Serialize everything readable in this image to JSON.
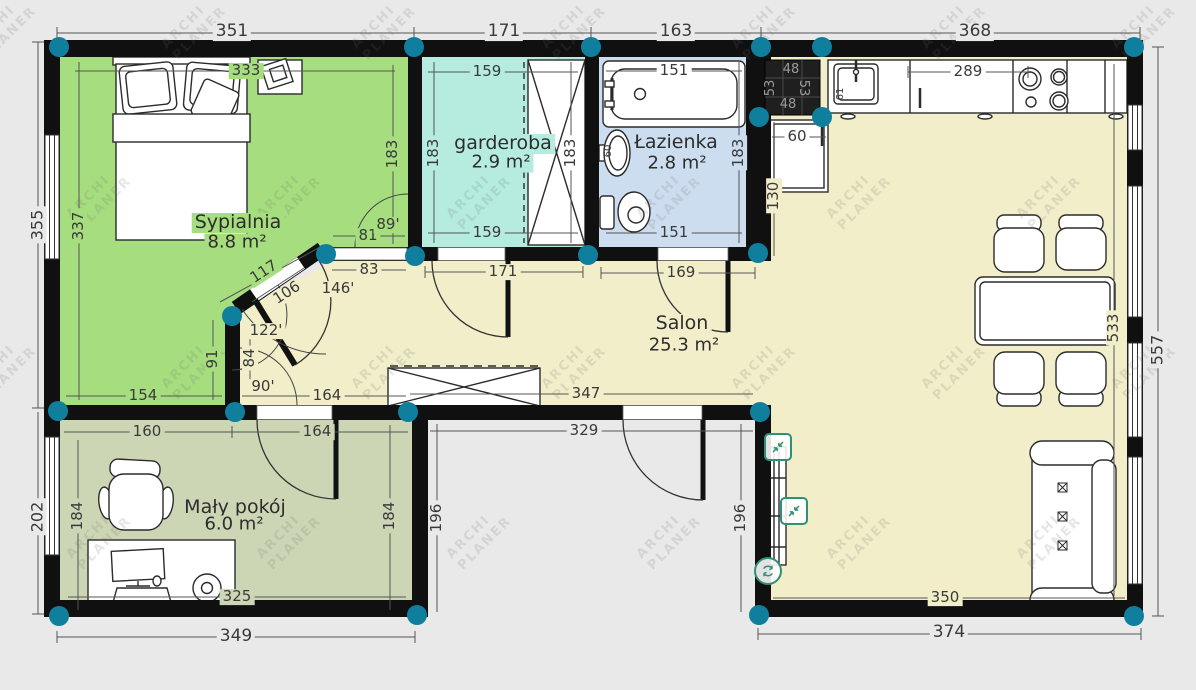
{
  "watermark": {
    "line1": "ARCHI",
    "line2": "PLANER"
  },
  "colors": {
    "background": "#e9e9e9",
    "wall": "#101010",
    "bedroom_fill": "#a6dd7e",
    "small_room_fill": "#ccd6b4",
    "wardrobe_fill": "#b5ecdf",
    "bathroom_fill": "#ccddf0",
    "living_fill": "#f2eeca",
    "corner_handle": "#107f9e",
    "selection_accent": "#2f9077"
  },
  "icons": {
    "scale": "shrink-arrows-icon",
    "rotate": "rotate-icon"
  },
  "rooms": {
    "sypialnia": {
      "name": "Sypialnia",
      "area": "8.8 m²"
    },
    "garderoba": {
      "name": "garderoba",
      "area": "2.9 m²"
    },
    "lazienka": {
      "name": "Łazienka",
      "area": "2.8 m²"
    },
    "salon": {
      "name": "Salon",
      "area": "25.3 m²"
    },
    "maly_pokoj": {
      "name": "Mały pokój",
      "area": "6.0 m²"
    }
  },
  "dims": {
    "top_1": "351",
    "top_2": "171",
    "top_3": "163",
    "top_4": "368",
    "bottom_left": "349",
    "bottom_right": "374",
    "left_top_out": "355",
    "left_top_in": "337",
    "left_bottom_out": "202",
    "right_out": "557",
    "salon_width_in": "533",
    "bed_top": "333",
    "bed_right": "183",
    "bed_seg": "91",
    "bed_bottom": "154",
    "bed_door": "81",
    "hall_83": "83",
    "hall_84": "84",
    "hall_164": "164",
    "hall_diag_len": "117",
    "hall_diag_door": "106",
    "gard_top": "159",
    "gard_left": "183",
    "gard_right": "183",
    "gard_bottom": "159",
    "gard_door": "171",
    "laz_top": "151",
    "laz_right": "183",
    "laz_bottom": "151",
    "laz_door": "169",
    "laz_sink": "60",
    "chimney_top": "48",
    "chimney_left": "53",
    "chimney_right": "53",
    "chimney_bottom": "48",
    "fridge_w": "60",
    "fridge_h": "130",
    "counter": "289",
    "sink_w": "61",
    "salon_347": "347",
    "salon_350": "350",
    "recess_329": "329",
    "recess_196_left": "196",
    "recess_196_right": "196",
    "maly_160": "160",
    "maly_164": "164",
    "maly_184_left": "184",
    "maly_184_right": "184",
    "maly_325": "325"
  },
  "angles": {
    "a146": "146'",
    "a122": "122'",
    "a90": "90'",
    "a89": "89'"
  }
}
